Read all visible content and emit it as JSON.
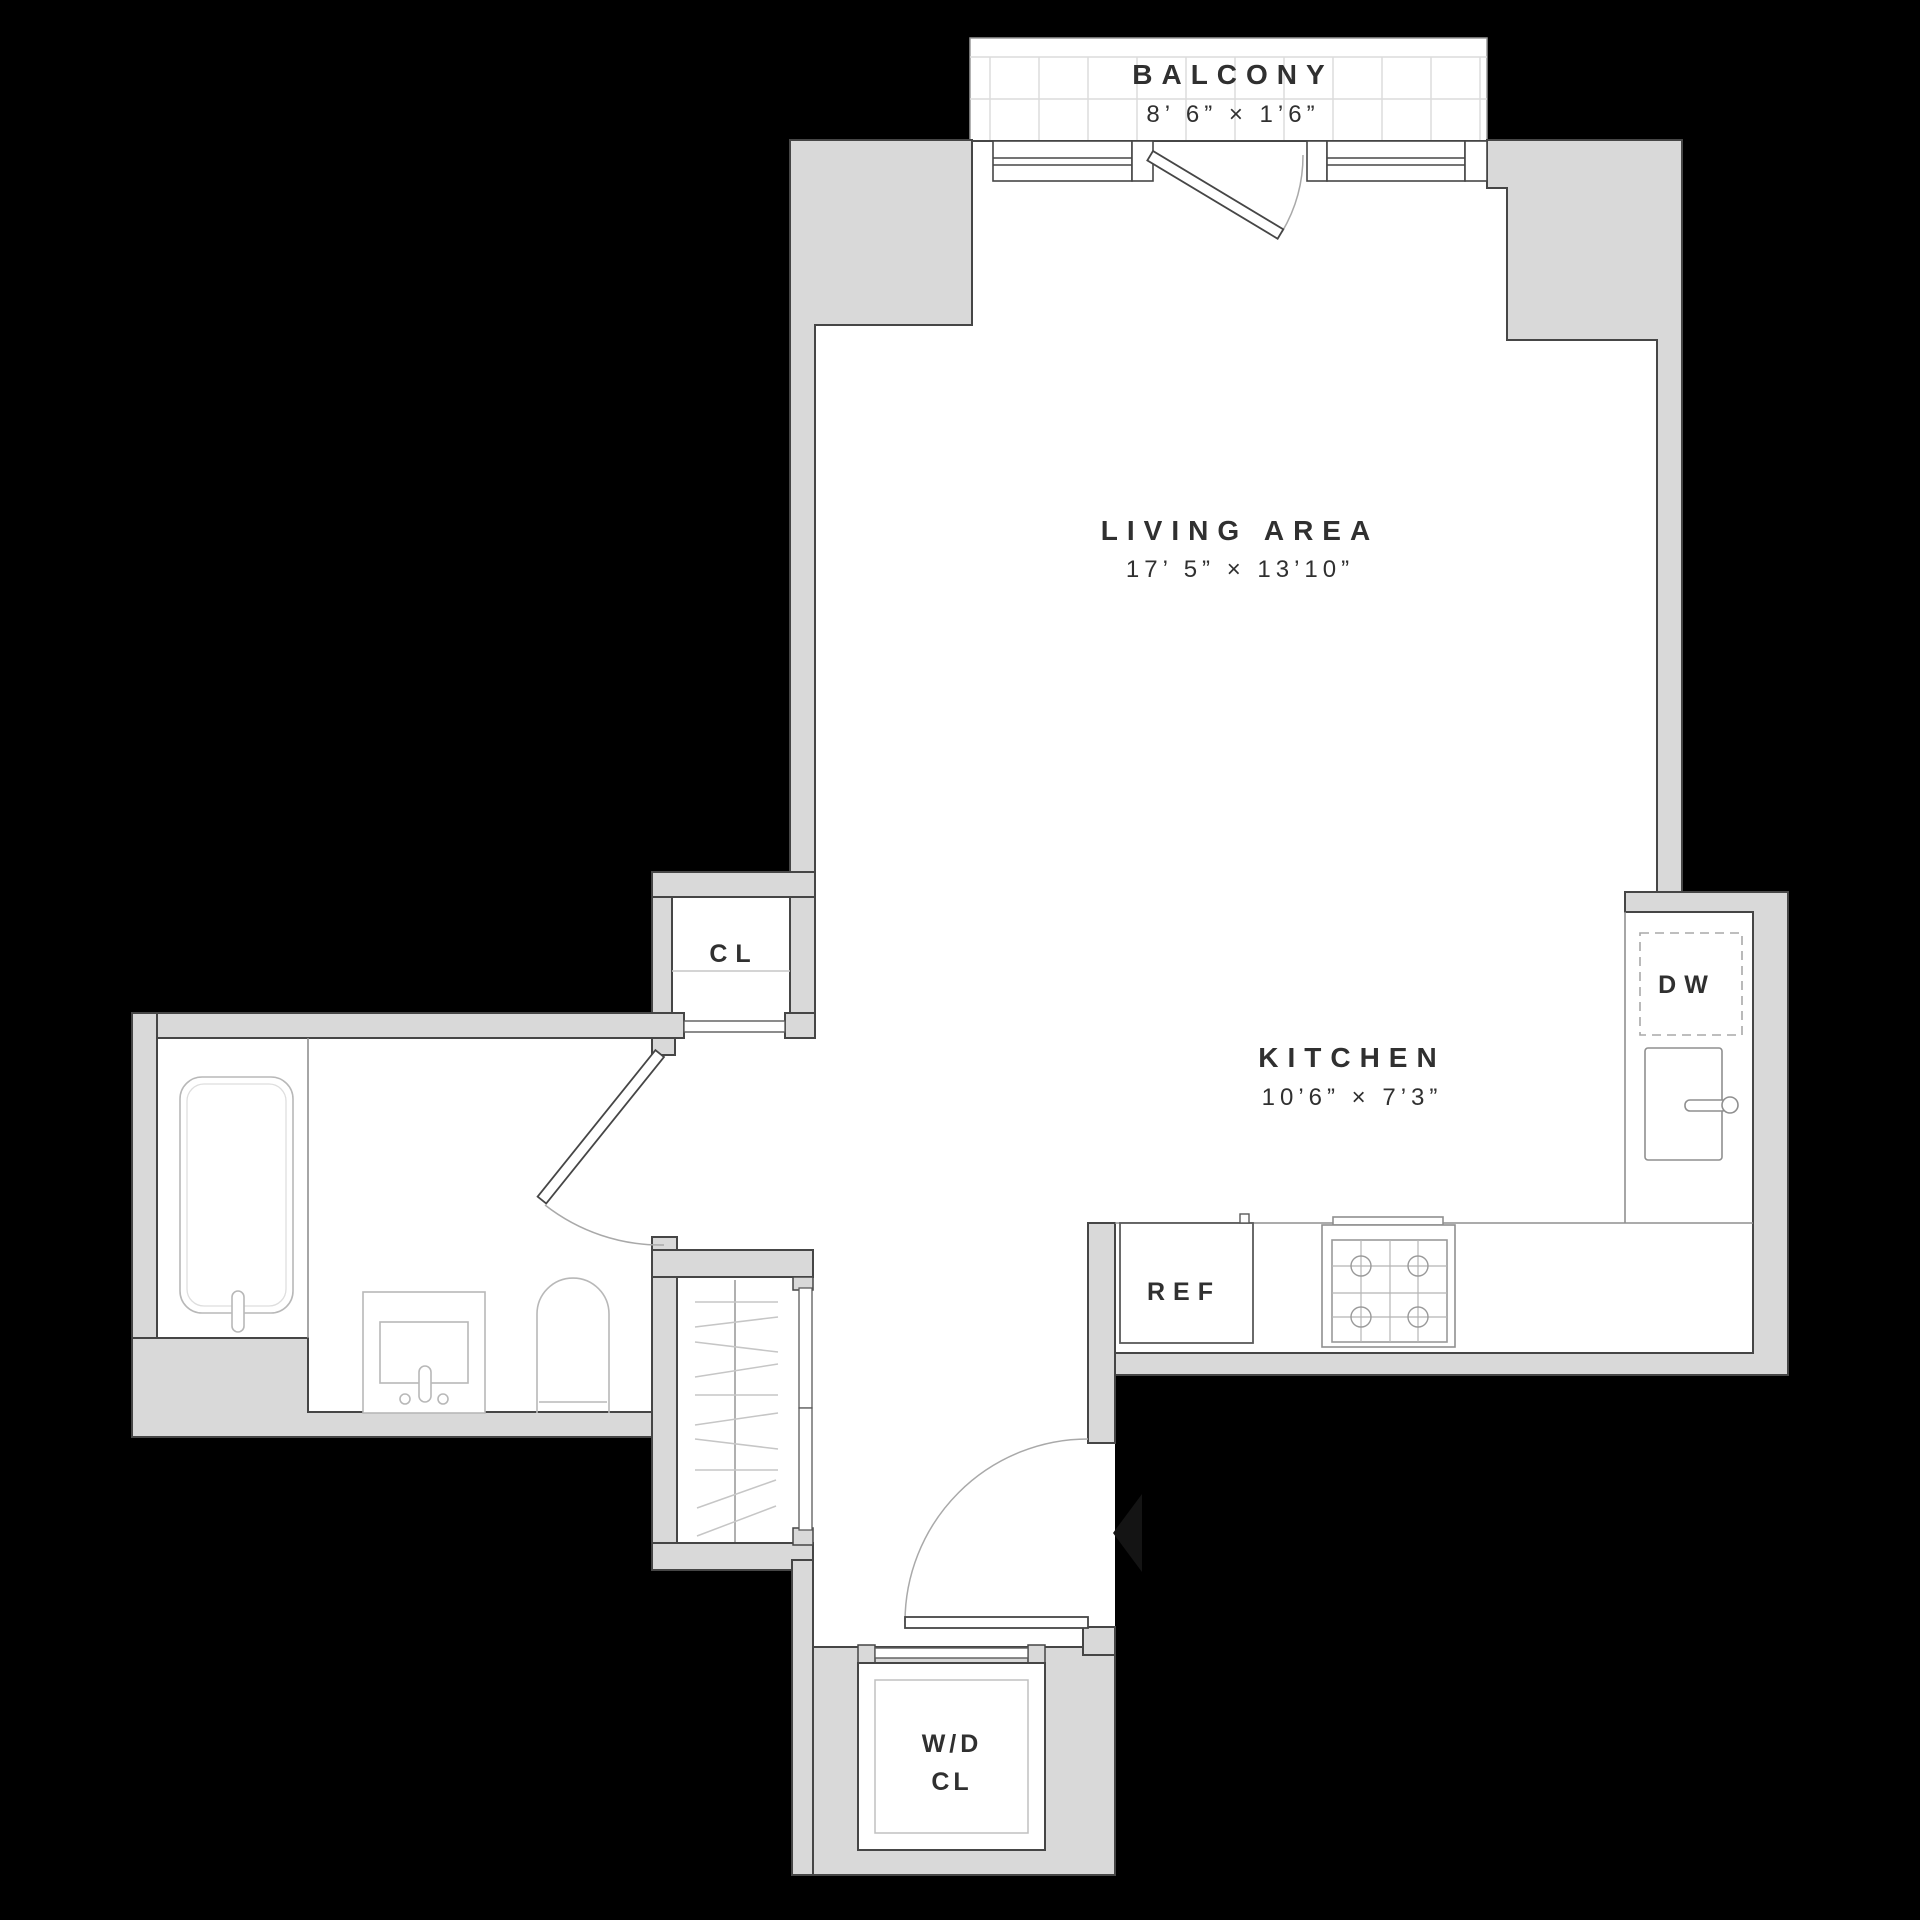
{
  "scene": {
    "type": "apartment-floor-plan",
    "background": "#000000"
  },
  "palette": {
    "wall_fill": "#d9d9d9",
    "wall_outline": "#464646",
    "floor": "#ffffff",
    "fixture_line": "#b8b8b8",
    "counter_line": "#8f8f8f",
    "balcony_grid": "#dcdcdc",
    "text": "#303030",
    "entry_arrow": "#141414"
  },
  "rooms": {
    "balcony": {
      "label": "BALCONY",
      "dims": "8’ 6” × 1’6”"
    },
    "living": {
      "label": "LIVING AREA",
      "dims": "17’ 5” × 13’10”"
    },
    "kitchen": {
      "label": "KITCHEN",
      "dims": "10’6” × 7’3”"
    },
    "closet": {
      "label": "CL"
    },
    "wd_closet": {
      "label_line1": "W/D",
      "label_line2": "CL"
    }
  },
  "appliances": {
    "dishwasher": "DW",
    "refrigerator": "REF"
  }
}
